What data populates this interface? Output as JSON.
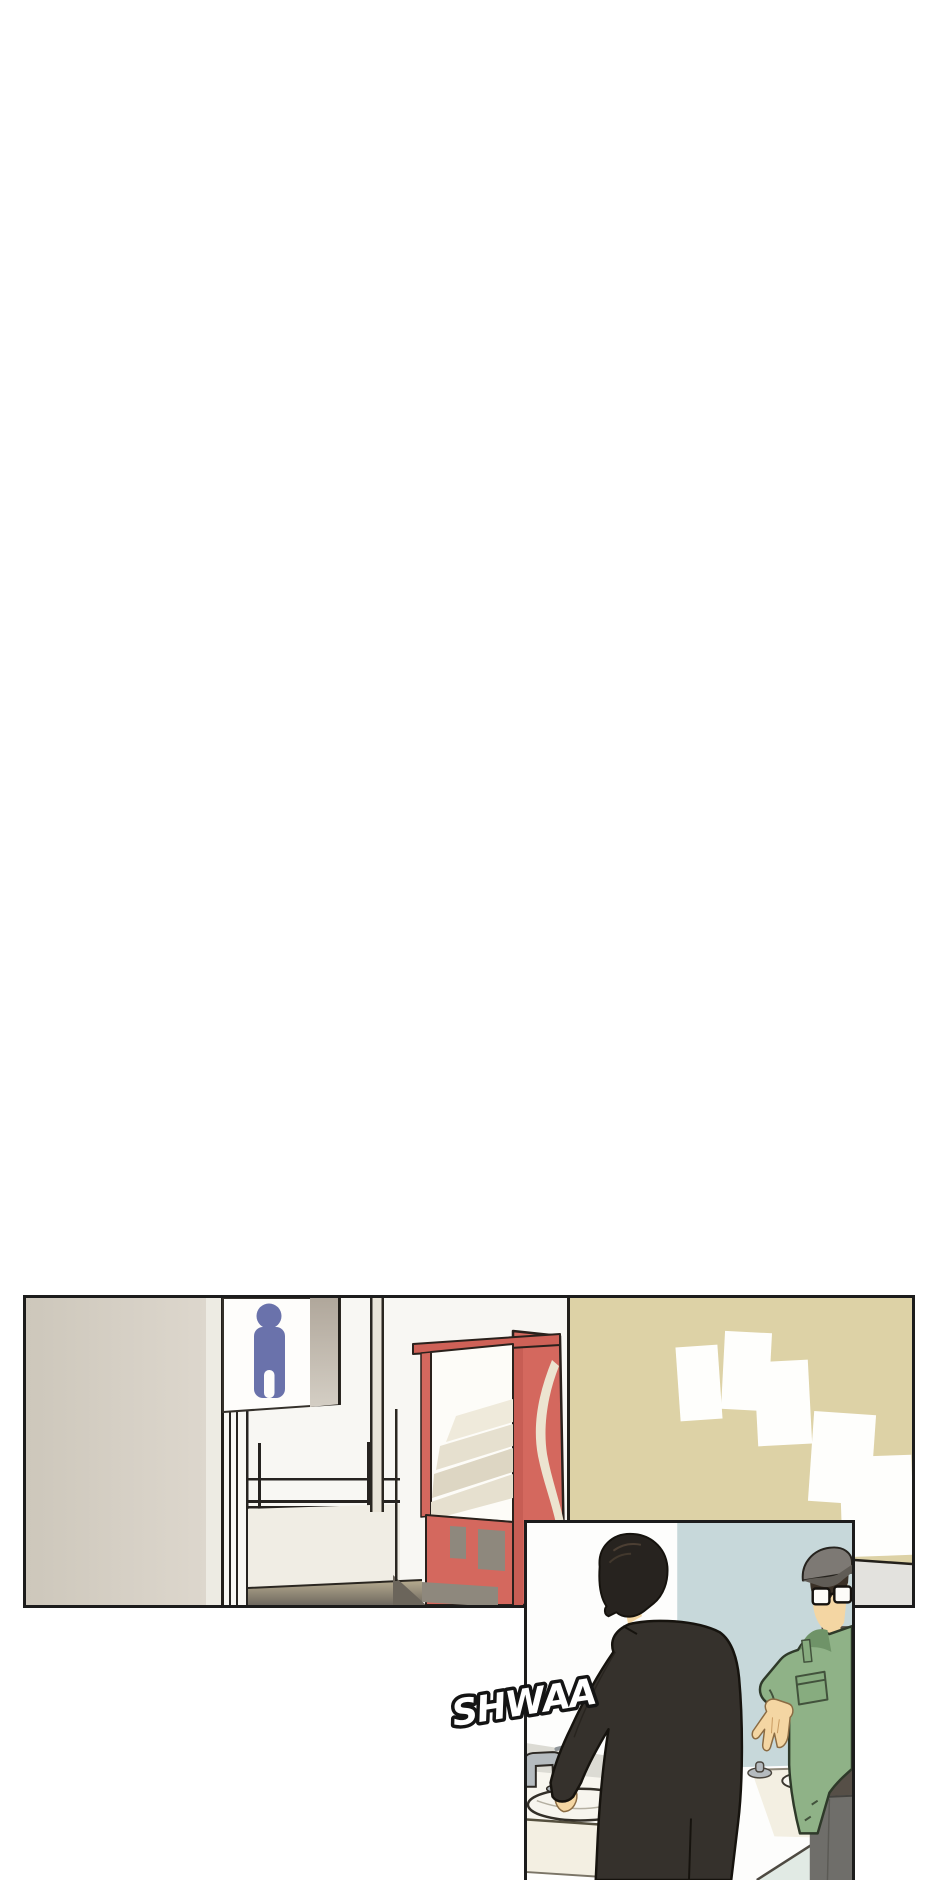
{
  "page": {
    "kind": "webtoon comic page, mostly blank with two panels at bottom",
    "background": "#ffffff"
  },
  "sfx": {
    "text": "SHWAA",
    "fill": "#ffffff",
    "outline": "#141414"
  },
  "panels": {
    "hallway": {
      "label": "hallway with restroom sign, vending machine and poster wall",
      "border_color": "#1c1c1c",
      "bg": "#f8f7f3",
      "left_wall": "#d5cfc3",
      "wall_edge_strip": "#edebe3",
      "alcove_white": "#fbfaf7",
      "line_color": "#262320",
      "sign_bg": "#fefdfb",
      "sign_icon": "male-restroom-pictogram",
      "sign_icon_color": "#6a72ab",
      "wainscot": "#f0ede4",
      "floor_dark": "#6b655b",
      "vending_red": "#d4685e",
      "vending_red_dark": "#c75d54",
      "vending_top": "#ce6157",
      "vending_glass": "#fdfcf8",
      "vending_swoosh": "#ece4d0",
      "vending_vent": "#8e887d",
      "bulletin_wall": "#ddd2a6",
      "poster_color": "#fefefc",
      "posters_count": 5,
      "lower_right_wall": "#e3e2de"
    },
    "bathroom": {
      "label": "two men at restroom sinks, one washing hands",
      "border_color": "#1c1c1c",
      "wall_white": "#fdfdfc",
      "wall_blue": "#c7d8da",
      "backsplash": "#dcdbd4",
      "counter": "#f3efe2",
      "counter_top": "#f8f6ef",
      "floor_teal": "#e1eae4",
      "sink": "#f7f5ee",
      "faucet": "#b5bbbf",
      "skin": "#f4d6a3",
      "man_coat": "#35312c",
      "man_hair": "#27231f",
      "hair_highlight": "#6b5844",
      "friend_jacket": "#8fb287",
      "friend_jacket_dark": "#6f9368",
      "friend_pocket": "#87ac7f",
      "friend_cap": "#7d7974",
      "friend_cap_visor": "#605c56",
      "friend_hair": "#3b3127",
      "friend_inner": "#564f47",
      "friend_trousers": "#6f6e6a"
    }
  }
}
